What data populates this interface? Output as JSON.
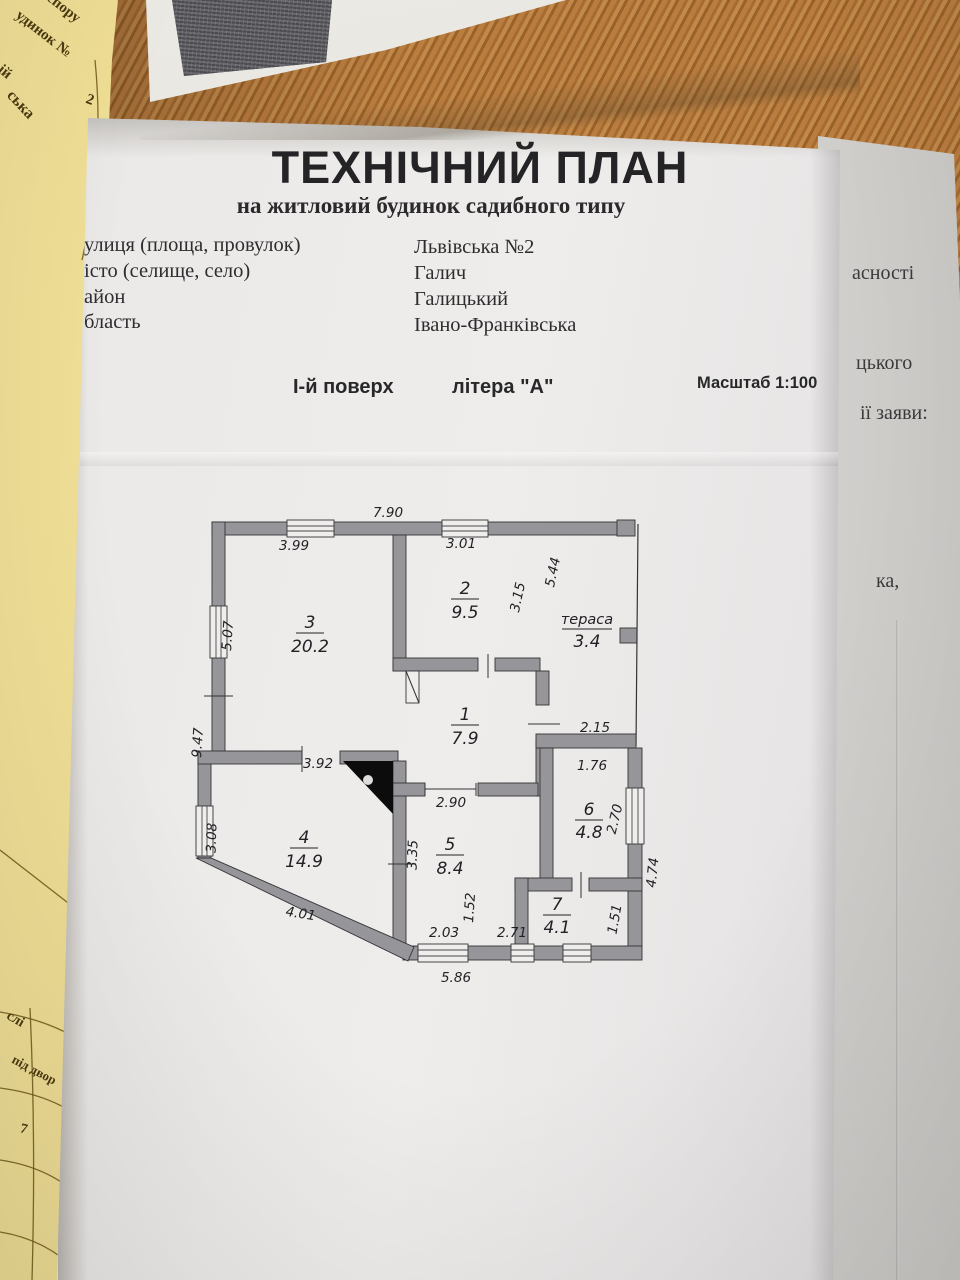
{
  "header": {
    "title": "ТЕХНІЧНИЙ ПЛАН",
    "subtitle": "на житловий будинок садибного типу"
  },
  "address": {
    "rows": [
      {
        "label": "улиця (площа, провулок)",
        "value": "Львівська   №2"
      },
      {
        "label": "істо (селище, село)",
        "value": "Галич"
      },
      {
        "label": "айон",
        "value": "Галицький"
      },
      {
        "label": "бласть",
        "value": "Івано-Франківська"
      }
    ]
  },
  "plan_header": {
    "floor": "І-й поверх",
    "letter": "літера \"А\"",
    "scale": "Масштаб 1:100"
  },
  "floor_plan": {
    "rooms": {
      "r1": {
        "number": "1",
        "area": "7.9"
      },
      "r2": {
        "number": "2",
        "area": "9.5"
      },
      "r3": {
        "number": "3",
        "area": "20.2"
      },
      "r4": {
        "number": "4",
        "area": "14.9"
      },
      "r5": {
        "number": "5",
        "area": "8.4"
      },
      "r6": {
        "number": "6",
        "area": "4.8"
      },
      "r7": {
        "number": "7",
        "area": "4.1"
      },
      "terrace": {
        "label": "тераса",
        "area": "3.4"
      }
    },
    "dims": {
      "top": "7.90",
      "r3_top": "3.99",
      "r2_top": "3.01",
      "r2_right": "3.15",
      "terrace_left": "5.44",
      "r3_left": "5.07",
      "left_total": "9.47",
      "r4_window": "3.08",
      "r4_top": "3.92",
      "r1_bottom": "2.90",
      "hall_width": "2.15",
      "r6_top": "1.76",
      "r6_right": "2.70",
      "right_total": "4.74",
      "r5_left": "3.35",
      "r5_passage": "1.52",
      "r4_diagonal": "4.01",
      "bottom_w1": "2.03",
      "bottom_w2": "2.71",
      "r7_right": "1.51",
      "bottom_total": "5.86"
    }
  },
  "left_page": {
    "f1": "спору",
    "f2": "удинок №",
    "f3": "ій",
    "f4": "ська",
    "f5": "2",
    "f6": "слі",
    "f7": "під двор",
    "f8": "7"
  },
  "right_page": {
    "f1": "асності",
    "f2": "цького",
    "f3": "ії заяви:",
    "f4": "ка,"
  },
  "colors": {
    "wood": "#ad7136",
    "paper_yellow": "#ecd88b",
    "wall_gray": "#96969a"
  }
}
